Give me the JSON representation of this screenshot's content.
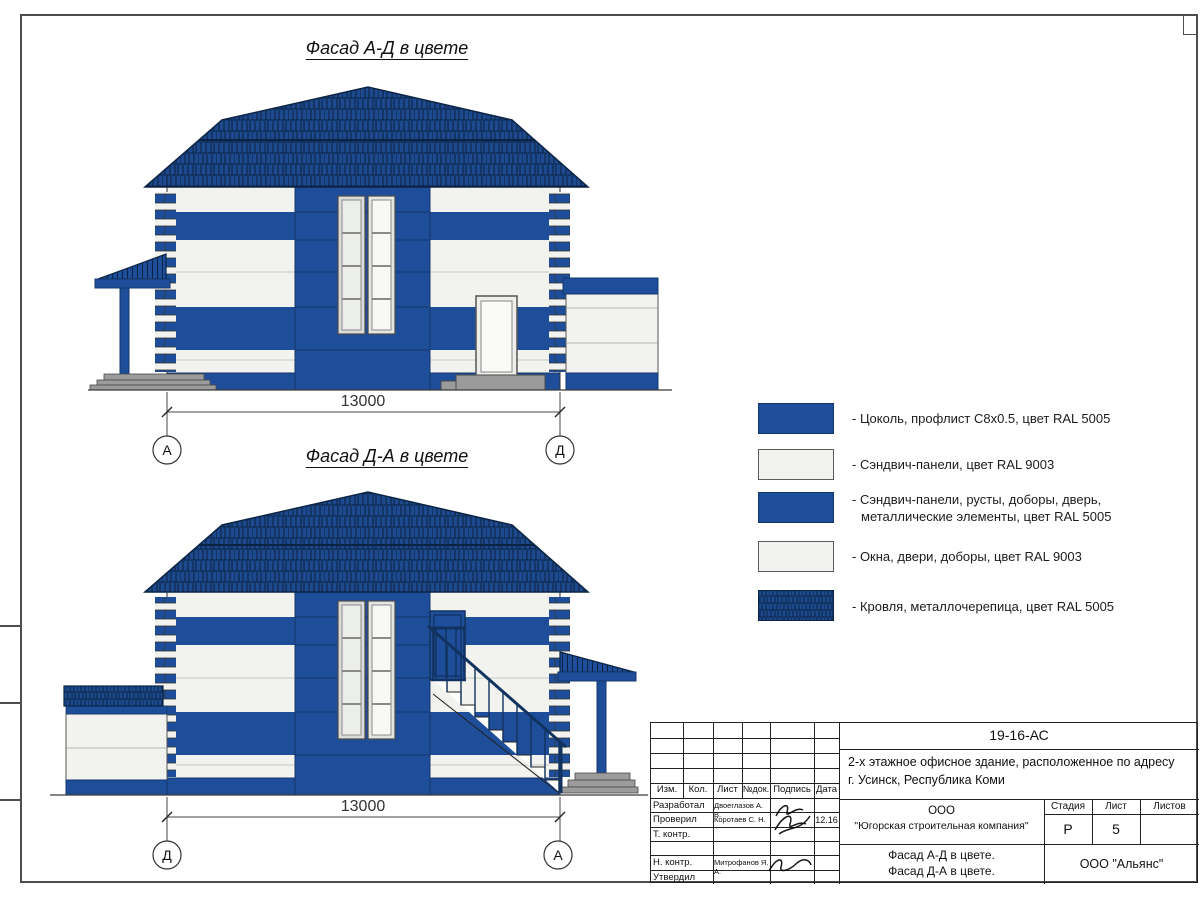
{
  "colors": {
    "ral5005": "#1e4e99",
    "ral9003": "#f2f3ef",
    "roofbg": "#1d4a8f",
    "roofline": "#0c2444",
    "grey": "#9b9b9b",
    "line": "#333333"
  },
  "titles": {
    "facade_ad": "Фасад А-Д в цвете",
    "facade_da": "Фасад Д-А в цвете"
  },
  "dims": {
    "top": "13000",
    "bottom": "13000"
  },
  "axes": {
    "top_left": "А",
    "top_right": "Д",
    "bottom_left": "Д",
    "bottom_right": "А"
  },
  "legend": {
    "items": [
      {
        "swatch": "blue",
        "label": "- Цоколь, профлист С8х0.5, цвет RAL 5005"
      },
      {
        "swatch": "white",
        "label": "- Сэндвич-панели, цвет RAL 9003"
      },
      {
        "swatch": "blue",
        "label": "- Сэндвич-панели, русты, доборы, дверь,",
        "label2": "металлические элементы, цвет RAL 5005"
      },
      {
        "swatch": "white",
        "label": "- Окна, двери, доборы, цвет RAL 9003"
      },
      {
        "swatch": "roof",
        "label": "- Кровля, металлочерепица, цвет RAL 5005"
      }
    ]
  },
  "title_block": {
    "doc_number": "19-16-АС",
    "description_line1": "2-х этажное офисное здание, расположенное по адресу",
    "description_line2": "г. Усинск, Республика Коми",
    "header_cells": [
      "Изм.",
      "Кол.",
      "Лист",
      "№док.",
      "Подпись",
      "Дата"
    ],
    "rows": [
      {
        "role": "Разработал",
        "name": "Двоеглазов А. В.",
        "date": ""
      },
      {
        "role": "Проверил",
        "name": "Коротаев С. Н.",
        "date": "12.16"
      },
      {
        "role": "Т. контр.",
        "name": "",
        "date": ""
      },
      {
        "role": "",
        "name": "",
        "date": ""
      },
      {
        "role": "Н. контр.",
        "name": "Митрофанов Я. А.",
        "date": ""
      },
      {
        "role": "Утвердил",
        "name": "",
        "date": ""
      }
    ],
    "company_line1": "ООО",
    "company_line2": "\"Югорская строительная компания\"",
    "stage_label": "Стадия",
    "sheet_label": "Лист",
    "sheets_label": "Листов",
    "stage_value": "Р",
    "sheet_value": "5",
    "sheets_value": "",
    "sheet_title_line1": "Фасад А-Д в цвете.",
    "sheet_title_line2": "Фасад Д-А в цвете.",
    "org": "ООО \"Альянс\""
  }
}
